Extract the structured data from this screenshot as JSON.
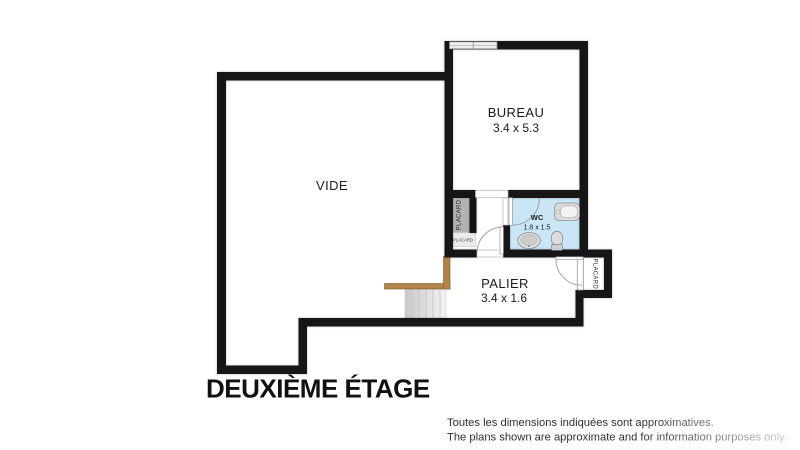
{
  "title": "DEUXIÈME ÉTAGE",
  "colors": {
    "wall": "#161616",
    "wc_fill": "#c9e5f6",
    "placard_fill": "#b3b3b3",
    "placard_small_fill": "#ebebeb",
    "railing": "#b2834a",
    "window_fill": "#ededed",
    "stairs_from": "#c9c9c9",
    "stairs_to": "#f4f4f4"
  },
  "rooms": {
    "vide": {
      "label": "VIDE"
    },
    "bureau": {
      "label": "BUREAU",
      "dimensions": "3.4 x 5.3"
    },
    "wc": {
      "label": "WC",
      "dimensions": "1.8 x 1.5"
    },
    "palier": {
      "label": "PALIER",
      "dimensions": "3.4 x 1.6"
    },
    "placard_hall_tall": {
      "label": "PLACARD"
    },
    "placard_hall_small": {
      "label": "PLACARD"
    },
    "placard_palier": {
      "label": "PLACARD"
    }
  },
  "disclaimer": {
    "line1": "Toutes les dimensions indiquées sont approximatives.",
    "line2": "The plans shown are approximate and for information purposes only."
  }
}
